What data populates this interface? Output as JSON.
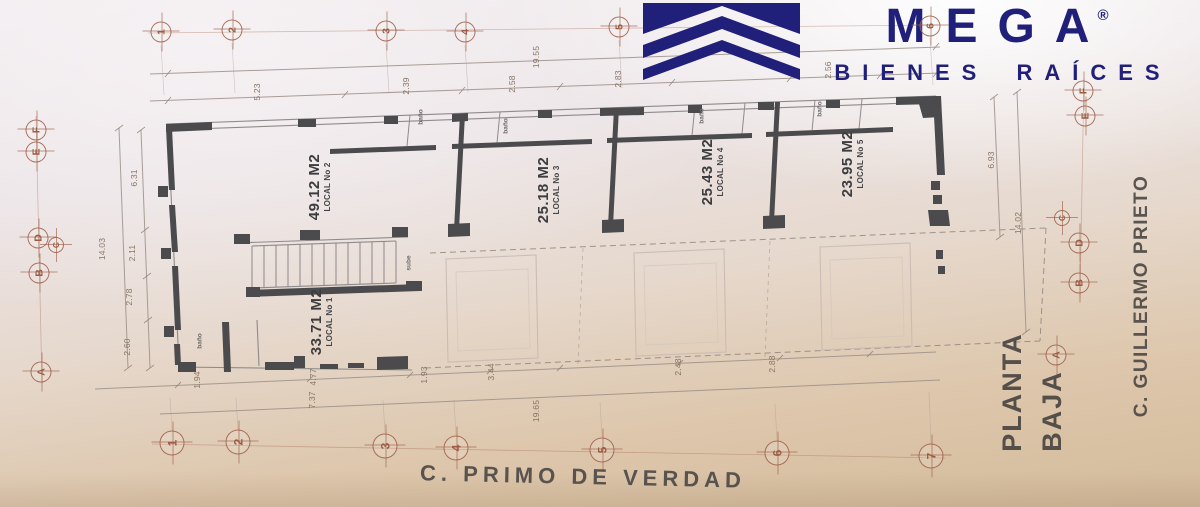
{
  "brand": {
    "name": "MEGA",
    "registered": "®",
    "tagline": "BIENES RAÍCES"
  },
  "plan_title": {
    "line1": "PLANTA",
    "line2": "BAJA"
  },
  "streets": {
    "bottom": "C. PRIMO DE VERDAD",
    "right": "C. GUILLERMO PRIETO"
  },
  "locals": {
    "l1": {
      "area": "33.71 M2",
      "name": "LOCAL No 1"
    },
    "l2": {
      "area": "49.12 M2",
      "name": "LOCAL No 2"
    },
    "l3": {
      "area": "25.18 M2",
      "name": "LOCAL No 3"
    },
    "l4": {
      "area": "25.43 M2",
      "name": "LOCAL No 4"
    },
    "l5": {
      "area": "23.95 M2",
      "name": "LOCAL No 5"
    }
  },
  "rooms": {
    "bath": "baño",
    "stair": "sube"
  },
  "axes": {
    "top": [
      "1",
      "2",
      "3",
      "4",
      "5",
      "6"
    ],
    "bottom": [
      "1",
      "2",
      "3",
      "4",
      "5",
      "6",
      "7"
    ],
    "left": [
      "F",
      "E",
      "D",
      "C",
      "B",
      "A"
    ],
    "right": [
      "F",
      "E",
      "C",
      "D",
      "B",
      "A"
    ]
  },
  "dims": {
    "top_total": "19.55",
    "t1": "5.23",
    "t2": "2.39",
    "t3": "2.58",
    "t4": "2.83",
    "t5": "2.56",
    "left_total": "14.03",
    "lv1": "6.31",
    "lv2": "2.11",
    "lv3": "2.78",
    "lv4": "2.60",
    "r1": "6.93",
    "r2": "14.02",
    "b1": "1.94",
    "b2": "4.77",
    "b3": "1.93",
    "b4": "3.44",
    "b5": "2.48",
    "b6": "2.88",
    "b7": "7.37",
    "b8": "19.65"
  },
  "colors": {
    "brand_navy": "#20207b",
    "wall": "#4b4b4e",
    "axis_marker": "#9e5c46"
  }
}
